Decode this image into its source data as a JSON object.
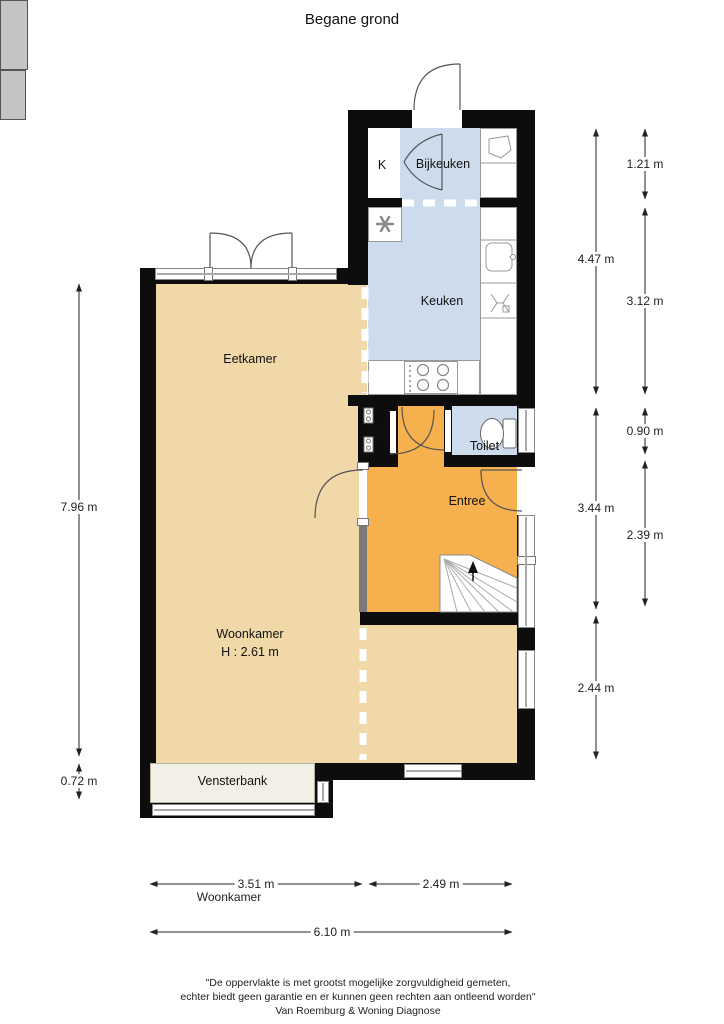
{
  "title": "Begane grond",
  "rooms": {
    "eetkamer": "Eetkamer",
    "woonkamer": "Woonkamer",
    "woonkamer_height": "H : 2.61 m",
    "keuken": "Keuken",
    "bijkeuken": "Bijkeuken",
    "kast": "K",
    "meterkast": "MK",
    "toilet": "Toilet",
    "entree": "Entree",
    "vensterbank": "Vensterbank"
  },
  "dimensions": {
    "right_inner": [
      "4.47 m",
      "3.44 m",
      "2.44 m"
    ],
    "right_outer": [
      "1.21 m",
      "3.12 m",
      "0.90 m",
      "2.39 m"
    ],
    "left": [
      "7.96 m",
      "0.72 m"
    ],
    "bottom": [
      "3.51 m",
      "2.49 m"
    ],
    "bottom_total": "6.10 m",
    "bottom_room_label": "Woonkamer"
  },
  "footer": {
    "line1": "\"De oppervlakte is met grootst mogelijke zorgvuldigheid gemeten,",
    "line2": "echter biedt geen garantie en er kunnen geen rechten aan ontleend worden\"",
    "line3": "Van Roemburg & Woning Diagnose"
  },
  "colors": {
    "wall": "#0d0d0d",
    "living_room": "#f0d8a8",
    "kitchen": "#ccdcec",
    "hallway": "#f6b04e",
    "closet": "#c4c4c4",
    "window_sill": "#f2efe6"
  }
}
